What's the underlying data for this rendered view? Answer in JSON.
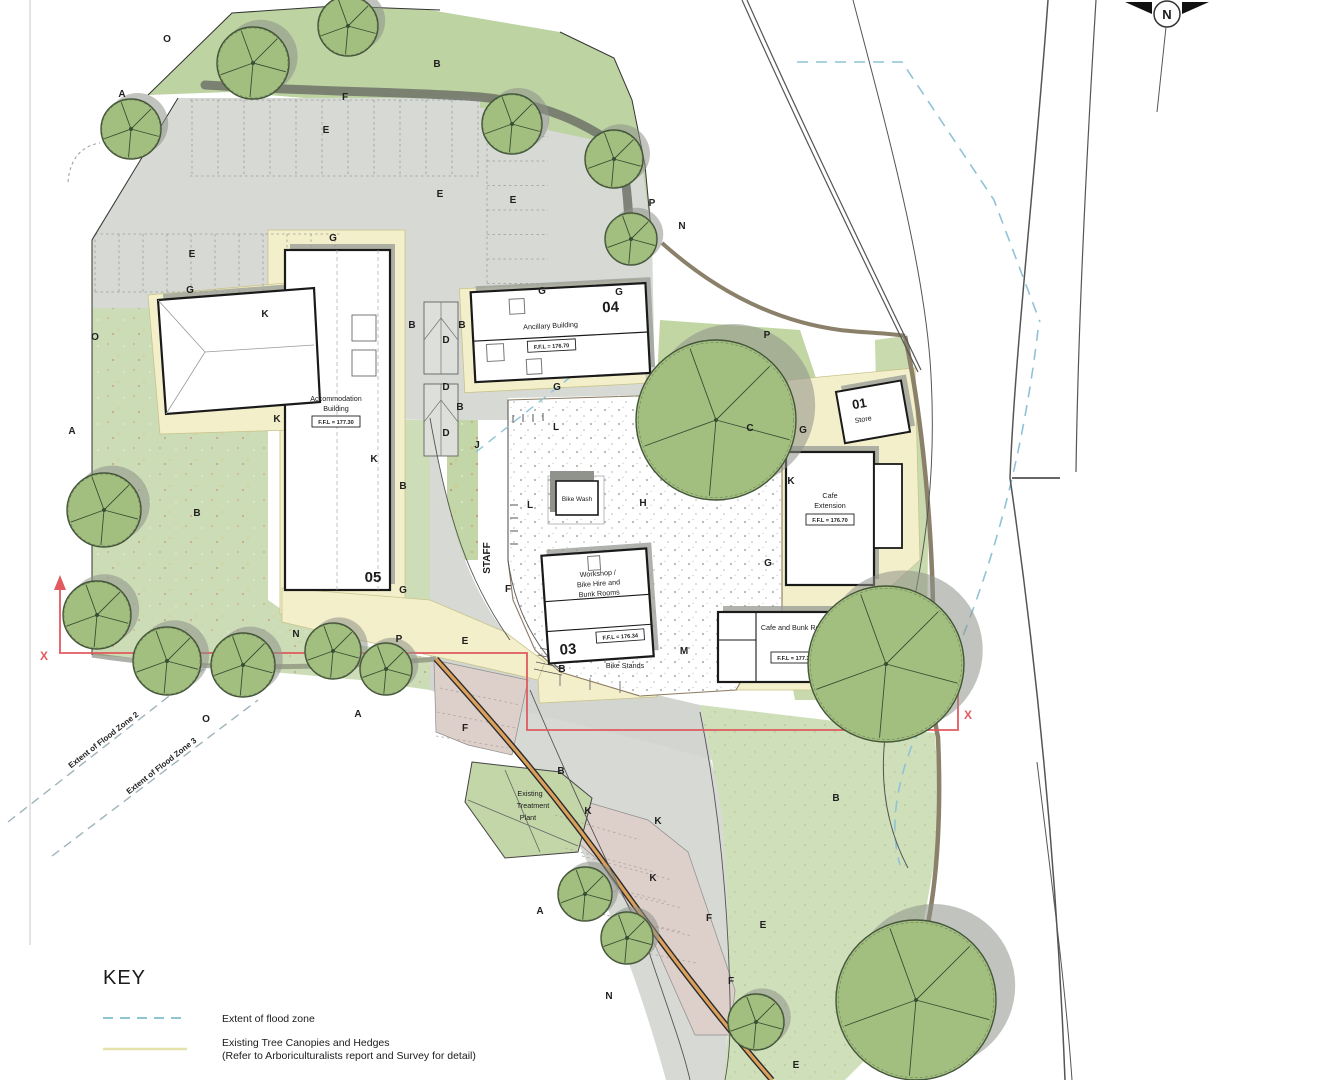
{
  "compass": {
    "n": "N"
  },
  "key": {
    "title": "KEY",
    "items": [
      {
        "label": "Extent of flood zone"
      },
      {
        "label": "Existing Tree Canopies and Hedges",
        "sub": "(Refer to Arboriculturalists report and Survey for detail)"
      }
    ]
  },
  "flood_zone_labels": {
    "zone2": "Extent of Flood Zone 2",
    "zone3": "Extent of Flood Zone 3"
  },
  "section": {
    "x_label": "X"
  },
  "buildings": {
    "b01": {
      "number": "01",
      "name": "Store"
    },
    "b02": {
      "number": "02",
      "name": "Cafe and Bunk Rooms",
      "ffl": "F.F.L = 177.30"
    },
    "b03": {
      "number": "03",
      "name_lines": [
        "Workshop /",
        "Bike Hire and",
        "Bunk Rooms"
      ],
      "ffl": "F.F.L = 176.34"
    },
    "b04": {
      "number": "04",
      "name": "Ancillary Building",
      "ffl": "F.F.L = 176.70"
    },
    "b05": {
      "number": "05",
      "name_lines": [
        "Accommodation",
        "Building"
      ],
      "ffl": "F.F.L = 177.30"
    },
    "cafe_extension": {
      "name_lines": [
        "Cafe",
        "Extension"
      ],
      "ffl": "F.F.L = 176.70"
    },
    "bike_wash": {
      "name": "Bike Wash"
    },
    "bike_stands": {
      "name": "Bike Stands"
    },
    "treatment_plant": {
      "name_lines": [
        "Existing",
        "Treatment",
        "Plant"
      ]
    }
  },
  "colors": {
    "section_line": "#e05a5e",
    "flood_dash": "#8fc3d6",
    "tree_key_line": "#e6e2ab",
    "tree_canopy": "#a3bf80"
  },
  "annotations": {
    "letters": [
      {
        "t": "O",
        "x": 167,
        "y": 42
      },
      {
        "t": "B",
        "x": 437,
        "y": 67
      },
      {
        "t": "A",
        "x": 122,
        "y": 97
      },
      {
        "t": "F",
        "x": 345,
        "y": 100
      },
      {
        "t": "E",
        "x": 326,
        "y": 133
      },
      {
        "t": "E",
        "x": 440,
        "y": 197
      },
      {
        "t": "E",
        "x": 513,
        "y": 203
      },
      {
        "t": "E",
        "x": 192,
        "y": 257
      },
      {
        "t": "P",
        "x": 652,
        "y": 206
      },
      {
        "t": "N",
        "x": 682,
        "y": 229
      },
      {
        "t": "G",
        "x": 333,
        "y": 241
      },
      {
        "t": "G",
        "x": 190,
        "y": 293
      },
      {
        "t": "K",
        "x": 265,
        "y": 317
      },
      {
        "t": "B",
        "x": 412,
        "y": 328
      },
      {
        "t": "B",
        "x": 462,
        "y": 328
      },
      {
        "t": "D",
        "x": 446,
        "y": 343
      },
      {
        "t": "D",
        "x": 446,
        "y": 390
      },
      {
        "t": "B",
        "x": 460,
        "y": 410
      },
      {
        "t": "D",
        "x": 446,
        "y": 436
      },
      {
        "t": "J",
        "x": 477,
        "y": 448
      },
      {
        "t": "K",
        "x": 277,
        "y": 422
      },
      {
        "t": "K",
        "x": 374,
        "y": 462
      },
      {
        "t": "B",
        "x": 403,
        "y": 489
      },
      {
        "t": "A",
        "x": 72,
        "y": 434
      },
      {
        "t": "O",
        "x": 95,
        "y": 340
      },
      {
        "t": "B",
        "x": 197,
        "y": 516
      },
      {
        "t": "G",
        "x": 542,
        "y": 294
      },
      {
        "t": "G",
        "x": 619,
        "y": 295
      },
      {
        "t": "G",
        "x": 557,
        "y": 390
      },
      {
        "t": "L",
        "x": 556,
        "y": 430
      },
      {
        "t": "L",
        "x": 530,
        "y": 508
      },
      {
        "t": "H",
        "x": 643,
        "y": 506
      },
      {
        "t": "C",
        "x": 750,
        "y": 431
      },
      {
        "t": "P",
        "x": 767,
        "y": 338
      },
      {
        "t": "G",
        "x": 803,
        "y": 433
      },
      {
        "t": "K",
        "x": 791,
        "y": 484
      },
      {
        "t": "G",
        "x": 768,
        "y": 566
      },
      {
        "t": "G",
        "x": 403,
        "y": 593
      },
      {
        "t": "F",
        "x": 508,
        "y": 592
      },
      {
        "t": "E",
        "x": 465,
        "y": 644
      },
      {
        "t": "M",
        "x": 684,
        "y": 654
      },
      {
        "t": "B",
        "x": 562,
        "y": 672
      },
      {
        "t": "N",
        "x": 296,
        "y": 637
      },
      {
        "t": "P",
        "x": 399,
        "y": 642
      },
      {
        "t": "O",
        "x": 206,
        "y": 722
      },
      {
        "t": "A",
        "x": 358,
        "y": 717
      },
      {
        "t": "F",
        "x": 465,
        "y": 731
      },
      {
        "t": "B",
        "x": 561,
        "y": 774
      },
      {
        "t": "K",
        "x": 588,
        "y": 814
      },
      {
        "t": "K",
        "x": 658,
        "y": 824
      },
      {
        "t": "K",
        "x": 653,
        "y": 881
      },
      {
        "t": "F",
        "x": 709,
        "y": 921
      },
      {
        "t": "E",
        "x": 763,
        "y": 928
      },
      {
        "t": "F",
        "x": 731,
        "y": 984
      },
      {
        "t": "A",
        "x": 540,
        "y": 914
      },
      {
        "t": "N",
        "x": 609,
        "y": 999
      },
      {
        "t": "E",
        "x": 796,
        "y": 1068
      },
      {
        "t": "B",
        "x": 836,
        "y": 801
      },
      {
        "t": "STAFF",
        "x": 490,
        "y": 558,
        "s": 4.5,
        "r": -90
      }
    ]
  }
}
